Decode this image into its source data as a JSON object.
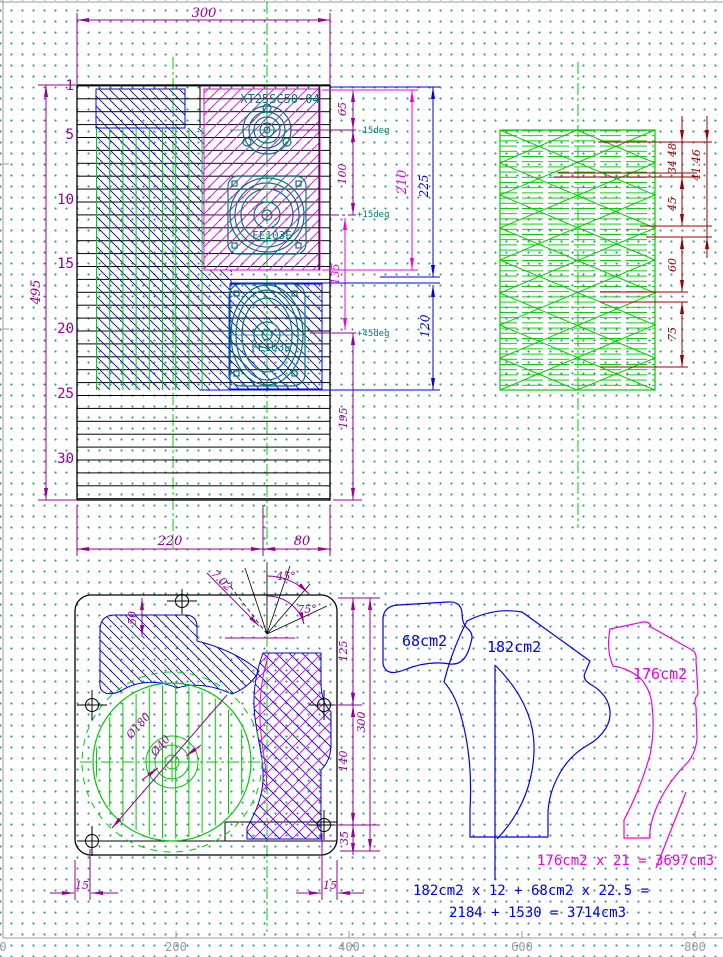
{
  "front_view": {
    "dim_top": "300",
    "dim_left": "495",
    "row_labels": [
      "1",
      "5",
      "10",
      "15",
      "20",
      "25",
      "30"
    ],
    "tweeter_label": "XT25SC50-04",
    "mid_label": "FE103E",
    "woofer_label": "FE103E",
    "angle_tweeter": "-15deg",
    "angle_mid": "+15deg",
    "angle_woofer": "+45deg",
    "dim_65": "65",
    "dim_100": "100",
    "dim_135": "135",
    "dim_195": "195",
    "dim_210": "210",
    "dim_225": "225",
    "dim_120": "120",
    "dim_220": "220",
    "dim_80": "80"
  },
  "side_panel": {
    "dim_48": "48",
    "dim_34": "34",
    "dim_4146": "41.46",
    "dim_45": "45",
    "dim_60": "60",
    "dim_75": "75"
  },
  "section_view": {
    "dim_50": "50",
    "dim_702": "7.02",
    "dim_45deg": "45°",
    "dim_75deg": "75°",
    "dim_125": "125",
    "dim_300": "300",
    "dim_140": "140",
    "dim_35": "35",
    "dim_15_left": "15",
    "dim_15_right": "15",
    "dia_180": "Ø180",
    "dia_40": "Ø40"
  },
  "areas": {
    "label_68": "68cm2",
    "label_182": "182cm2",
    "label_176": "176cm2",
    "formula_176": "176cm2 x 21 = 3697cm3",
    "formula_182_line1": "182cm2 x 12 + 68cm2 x 22.5 =",
    "formula_182_line2": "2184 + 1530 = 3714cm3"
  },
  "ruler": {
    "t0": "0",
    "t200": "200",
    "t400": "400",
    "t600": "600",
    "t800": "800"
  },
  "colors": {
    "purple": "#990099",
    "magenta": "#ee00ee",
    "blue": "#0000ee",
    "green": "#00cc00",
    "teal": "#007878",
    "darkred": "#990000",
    "gray": "#9a9a9a",
    "black": "#000000",
    "grid_dot": "#2e8f8f"
  }
}
